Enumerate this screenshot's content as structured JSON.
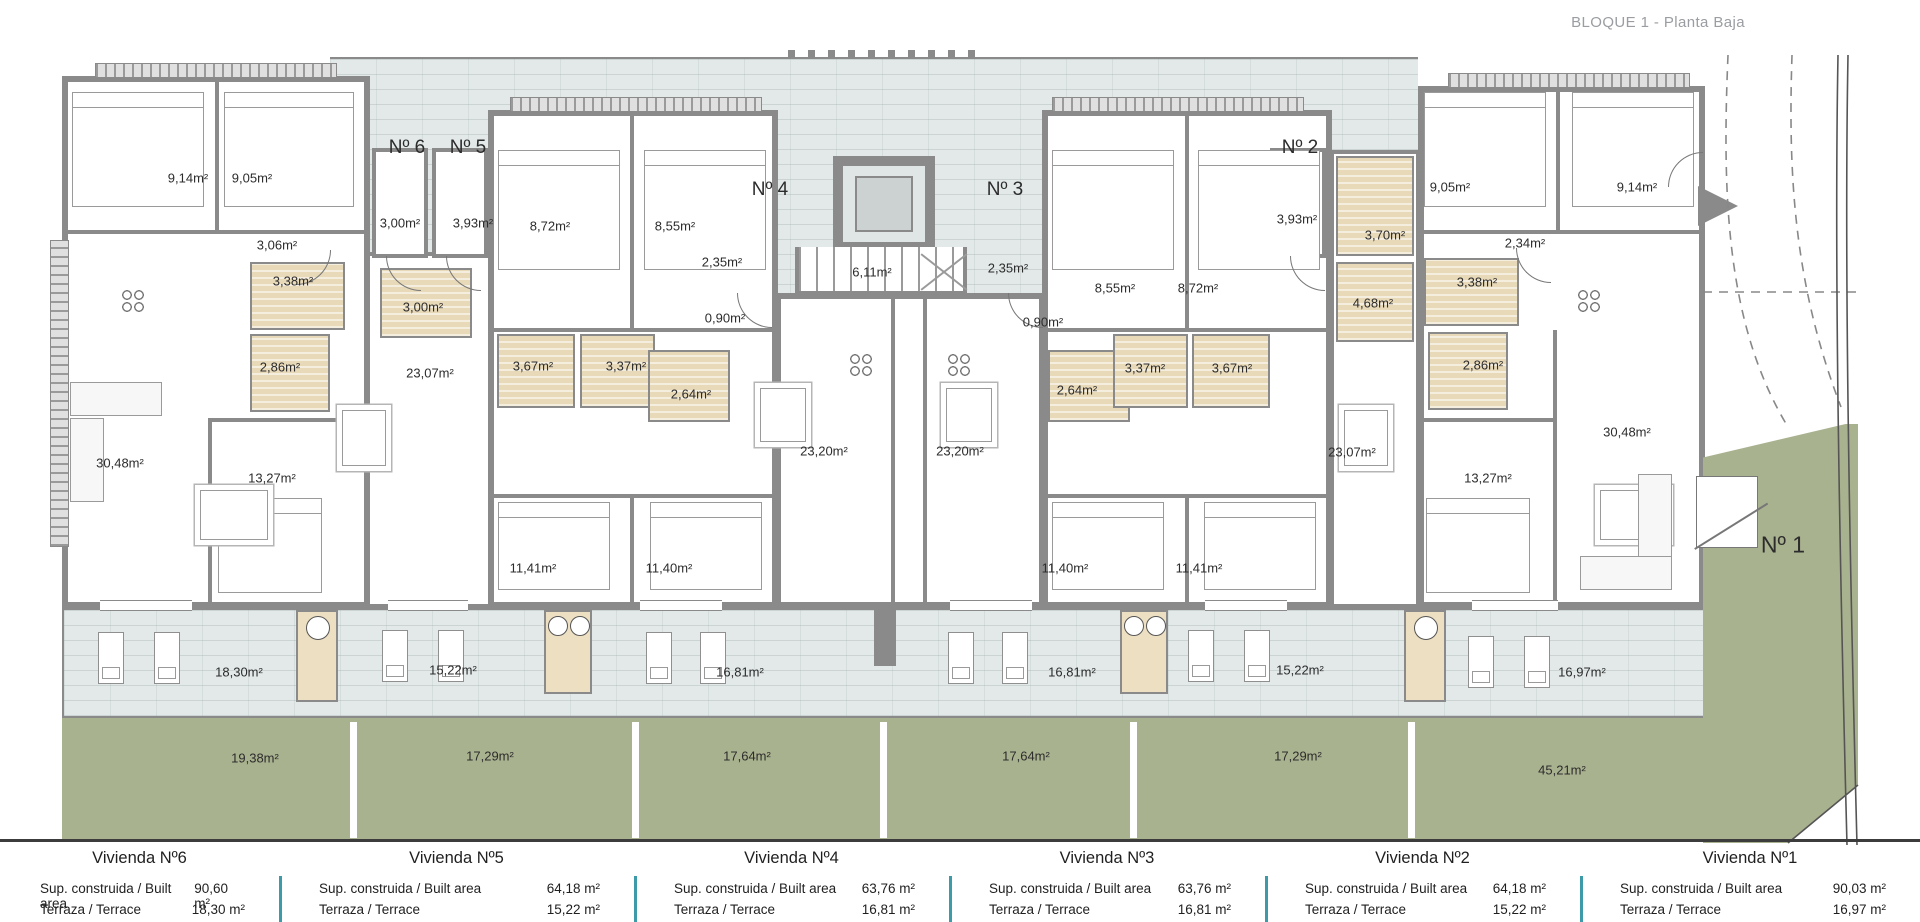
{
  "title": "BLOQUE 1 - Planta Baja",
  "colors": {
    "wall_gray": "#8a8a8a",
    "walkway_terrace_tile": "#e3e9e9",
    "garden_green": "#a9b28f",
    "bathroom_tan": "#e8d9b8",
    "table_divider_teal": "#3d9aa8",
    "title_gray": "#9a9da1"
  },
  "plan": {
    "unit_labels": [
      "Nº 6",
      "Nº 5",
      "Nº 4",
      "Nº 3",
      "Nº 2"
    ],
    "garden_unit_label": "Nº 1",
    "room_labels": [
      "9,14m²",
      "9,05m²",
      "3,06m²",
      "3,00m²",
      "3,93m²",
      "3,38m²",
      "3,00m²",
      "2,86m²",
      "23,07m²",
      "30,48m²",
      "13,27m²",
      "8,72m²",
      "8,55m²",
      "2,35m²",
      "6,11m²",
      "0,90m²",
      "3,67m²",
      "3,37m²",
      "2,64m²",
      "23,20m²",
      "23,20m²",
      "11,41m²",
      "11,40m²",
      "2,35m²",
      "8,55m²",
      "8,72m²",
      "3,93m²",
      "3,70m²",
      "0,90m²",
      "4,68m²",
      "2,64m²",
      "3,37m²",
      "3,67m²",
      "23,07m²",
      "11,40m²",
      "11,41m²",
      "9,05m²",
      "9,14m²",
      "2,34m²",
      "3,38m²",
      "2,86m²",
      "30,48m²",
      "13,27m²",
      "18,30m²",
      "15,22m²",
      "16,81m²",
      "16,81m²",
      "15,22m²",
      "16,97m²",
      "19,38m²",
      "17,29m²",
      "17,64m²",
      "17,64m²",
      "17,29m²",
      "45,21m²"
    ]
  },
  "table": {
    "columns": [
      {
        "title": "Vivienda Nº6",
        "rows": [
          {
            "label": "Sup. construida / Built area",
            "value": "90,60 m²"
          },
          {
            "label": "Terraza / Terrace",
            "value": "18,30 m²"
          }
        ]
      },
      {
        "title": "Vivienda Nº5",
        "rows": [
          {
            "label": "Sup. construida / Built area",
            "value": "64,18 m²"
          },
          {
            "label": "Terraza / Terrace",
            "value": "15,22 m²"
          }
        ]
      },
      {
        "title": "Vivienda Nº4",
        "rows": [
          {
            "label": "Sup. construida / Built area",
            "value": "63,76 m²"
          },
          {
            "label": "Terraza / Terrace",
            "value": "16,81 m²"
          }
        ]
      },
      {
        "title": "Vivienda Nº3",
        "rows": [
          {
            "label": "Sup. construida / Built area",
            "value": "63,76 m²"
          },
          {
            "label": "Terraza / Terrace",
            "value": "16,81 m²"
          }
        ]
      },
      {
        "title": "Vivienda Nº2",
        "rows": [
          {
            "label": "Sup. construida / Built area",
            "value": "64,18 m²"
          },
          {
            "label": "Terraza / Terrace",
            "value": "15,22 m²"
          }
        ]
      },
      {
        "title": "Vivienda Nº1",
        "rows": [
          {
            "label": "Sup. construida / Built area",
            "value": "90,03 m²"
          },
          {
            "label": "Terraza / Terrace",
            "value": "16,97 m²"
          }
        ]
      }
    ]
  }
}
